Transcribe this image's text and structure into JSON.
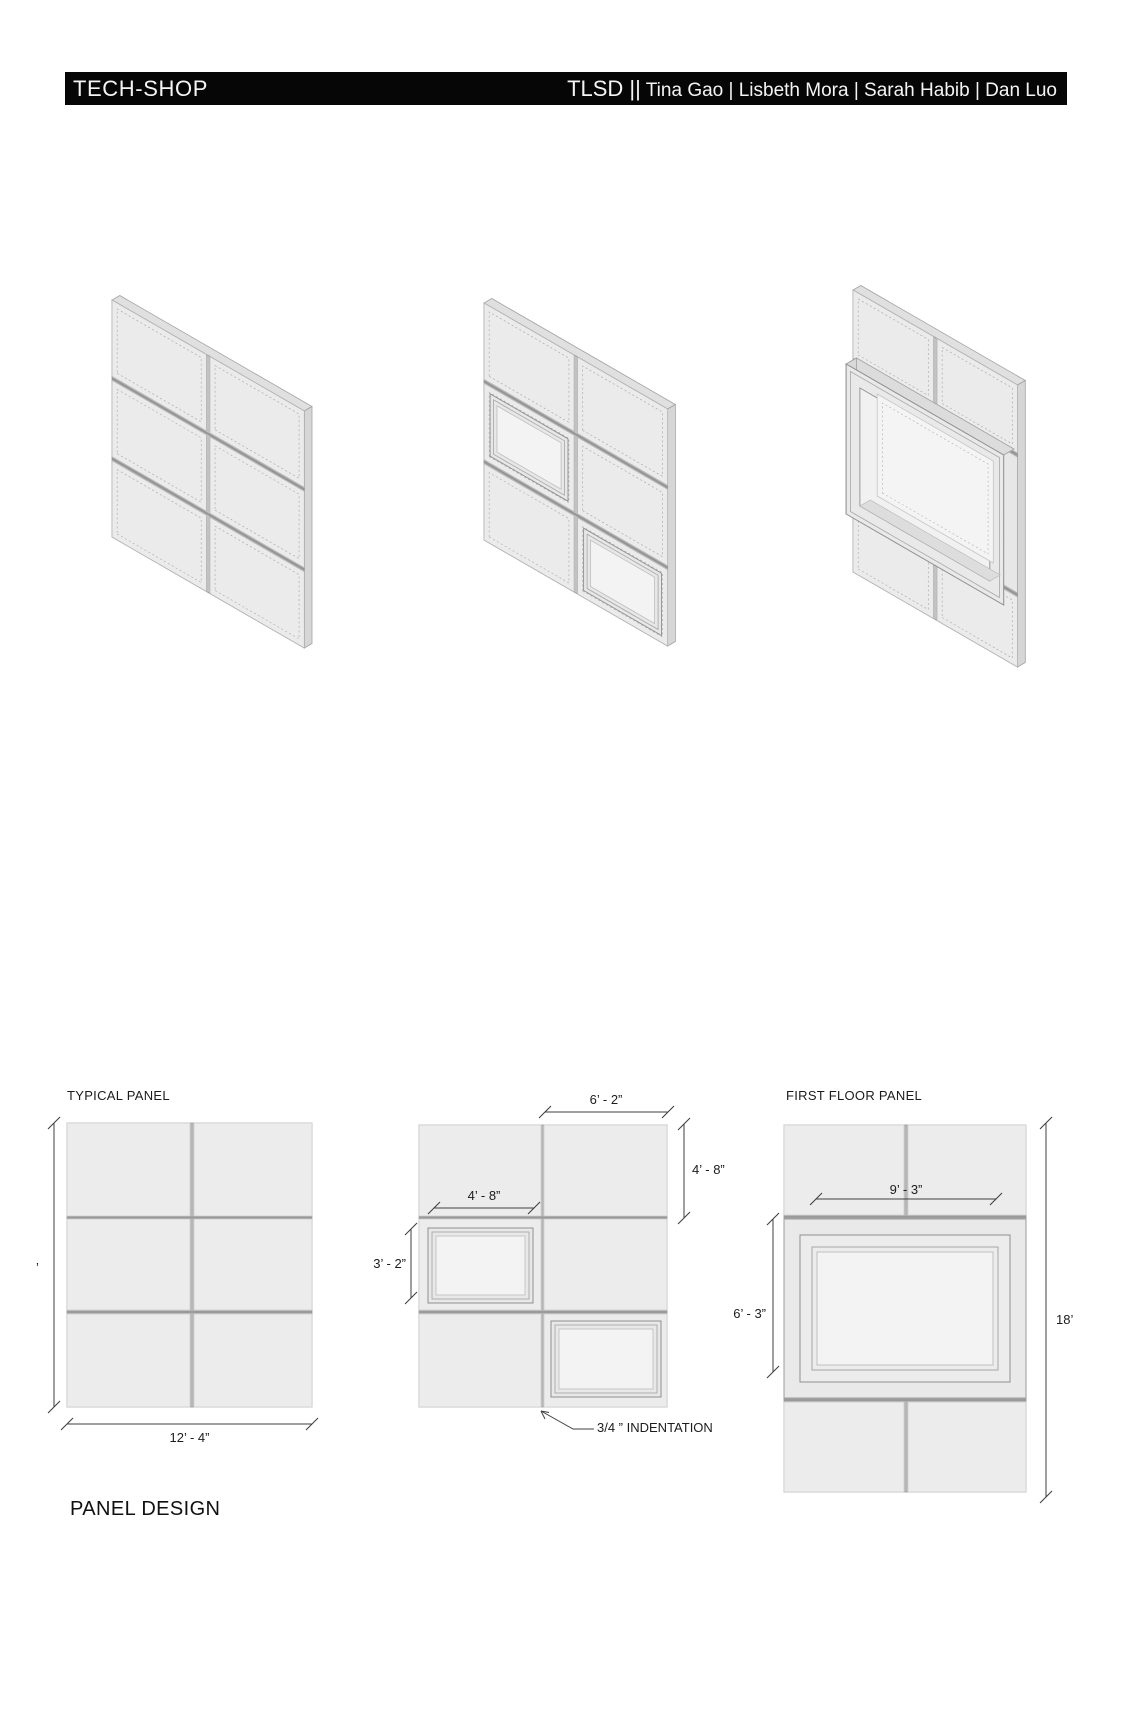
{
  "header": {
    "studio": "TECH-SHOP",
    "team_prefix": "TLSD ||",
    "team_names": " Tina Gao | Lisbeth Mora | Sarah Habib | Dan Luo"
  },
  "section_title": "PANEL DESIGN",
  "colors": {
    "header_bg": "#060606",
    "panel_fill": "#ececec",
    "dim_line": "#3f3f3f"
  },
  "elevations": {
    "typical": {
      "label": "TYPICAL PANEL",
      "width_dim": "12’ - 4”",
      "height_dim_partial": "’"
    },
    "variation": {
      "top_width_dim": "6’ - 2”",
      "top_height_dim": "4’ - 8”",
      "window_width_dim": "4’ - 8”",
      "window_height_dim": "3’ - 2”",
      "indent_note": "3/4 ” INDENTATION"
    },
    "first_floor": {
      "label": "FIRST FLOOR PANEL",
      "window_width_dim": "9’ - 3”",
      "window_height_dim": "6’ - 3”",
      "height_dim": "18’"
    }
  }
}
